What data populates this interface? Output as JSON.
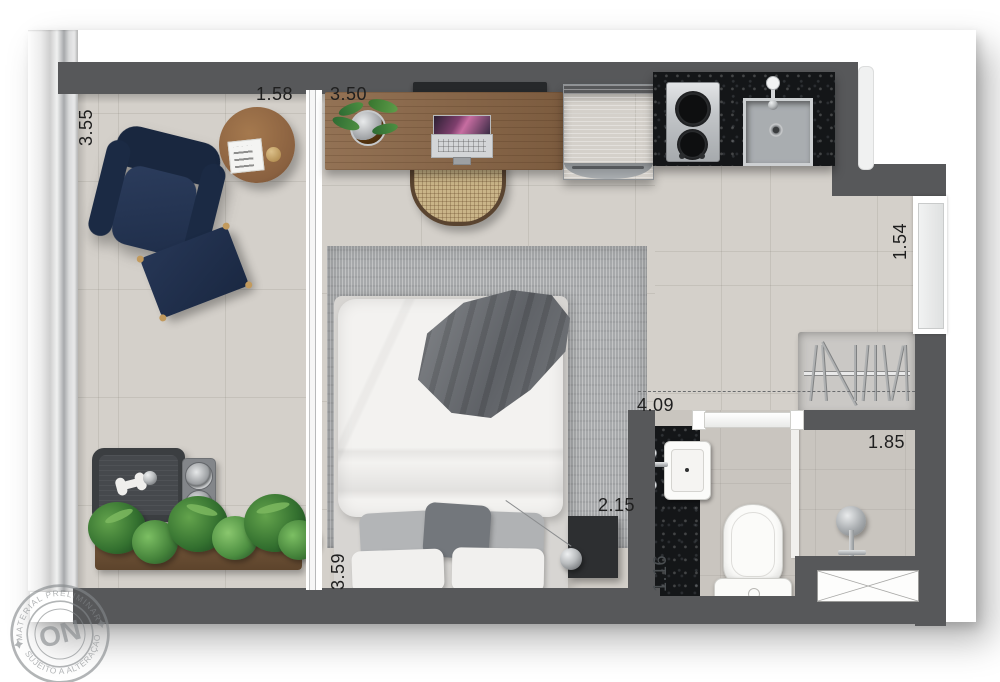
{
  "plan": {
    "title": "studio-apartment-floor-plan",
    "watermark": {
      "center": "ON",
      "arc_top": "MATERIAL PRELIMINAR",
      "arc_bottom": "SUJEITO A ALTERAÇÃO"
    },
    "dimensions": {
      "living_width": "3.55",
      "sliding_door_width": "1.58",
      "bedroom_width": "3.50",
      "entry_width": "1.54",
      "bath_corridor_length": "4.09",
      "shower_room_width": "1.85",
      "nightstand_wall": "2.15",
      "bedroom_depth": "3.59",
      "vanity_length": "1.16"
    },
    "colors": {
      "wall": "#57585a",
      "floor": "#d4d0ca",
      "bath_floor": "#c9c5bf",
      "granite_counter": "#141618",
      "wood": "#8a6646",
      "navy_upholstery": "#1d2b45",
      "rug": "#a7a9ab",
      "plant_green": "#3f7d39",
      "fixture_white": "#fbfbf9",
      "steel": "#b9bcbf"
    },
    "elements": [
      "armchair",
      "ottoman",
      "side-table",
      "sliding-door",
      "desk",
      "laptop",
      "desk-chair",
      "desk-plant",
      "tv",
      "fridge",
      "cooktop",
      "kitchen-sink",
      "bed",
      "rug",
      "throw-blanket",
      "pillows",
      "nightstand",
      "pendant-lamp",
      "dog-bed",
      "pet-bowls",
      "planter",
      "closet-hangers",
      "entry-door",
      "bathroom-door",
      "vanity-sink",
      "toilet",
      "shower",
      "service-shaft"
    ]
  }
}
